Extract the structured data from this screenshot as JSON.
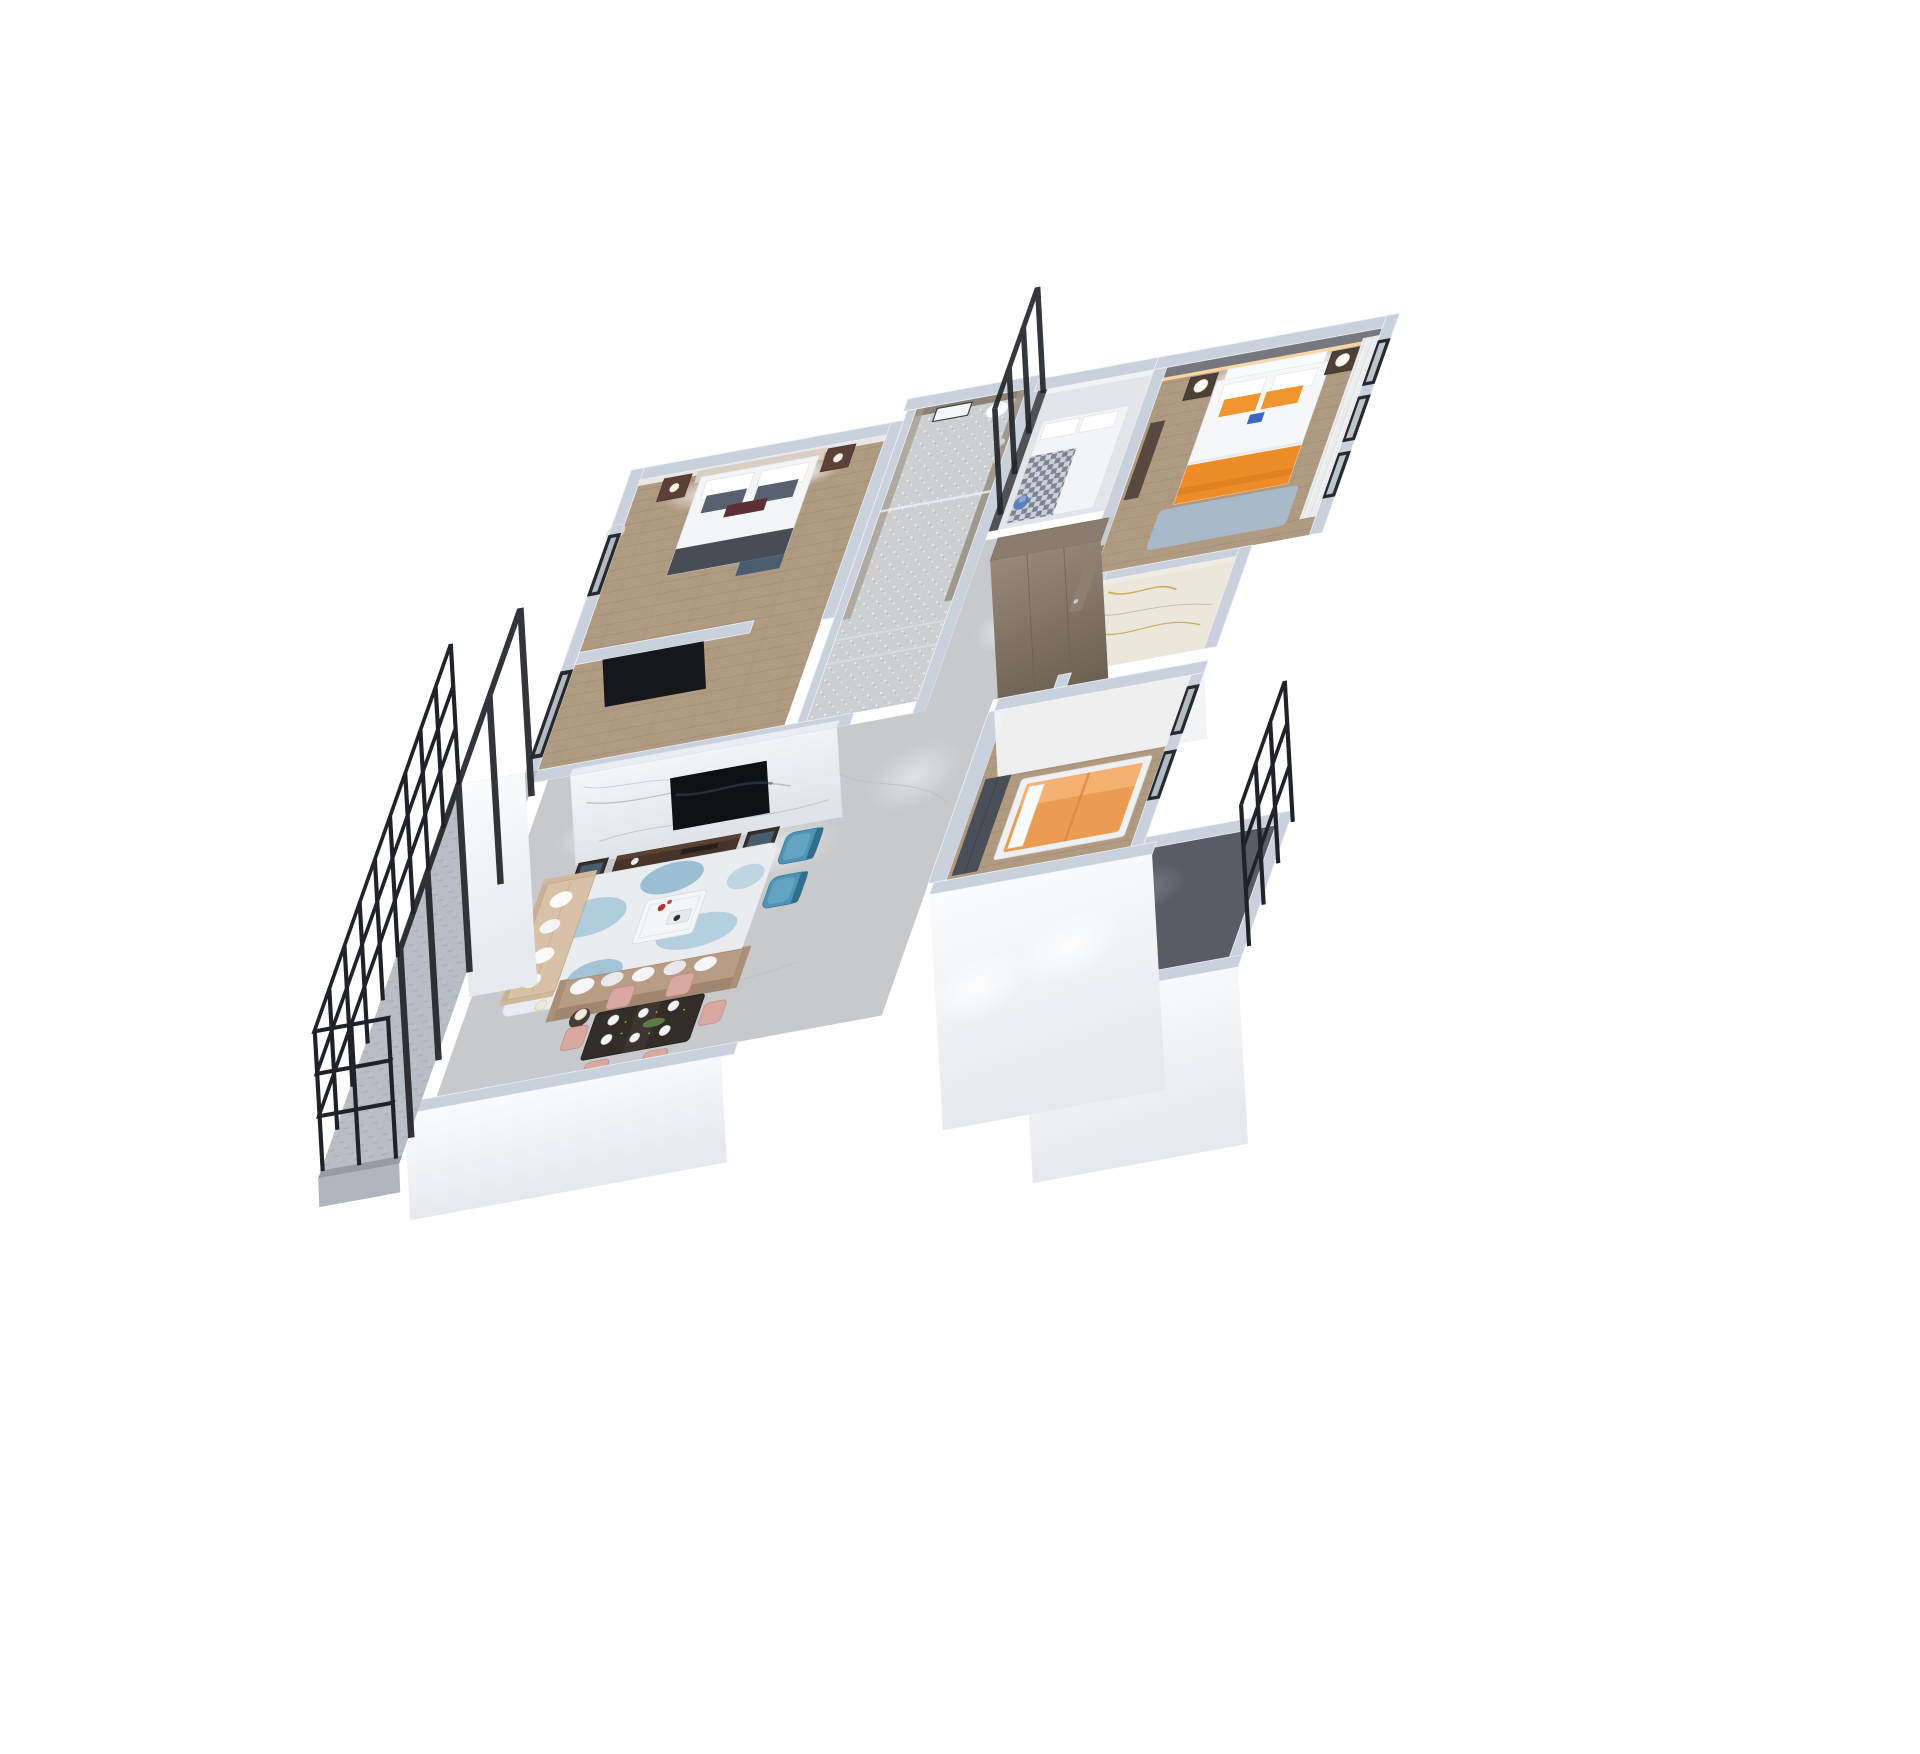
{
  "scene": {
    "title": "3D apartment floor plan render",
    "description": "Isometric cutaway (dollhouse) rendering of a three-bedroom apartment viewed from above on a plain white background, with living-dining room, two bathrooms, entry foyer and two balconies",
    "style": "photorealistic architectural visualization, oblique top-down view",
    "background": "#ffffff"
  },
  "palette": {
    "wall_top": "#c9d1dd",
    "wall_face": "#f5f7fa",
    "wood_floor": "#b09a82",
    "marble_floor": "#c7c9cc",
    "sparkle_floor": "#cdd0d2",
    "light_tile": "#e2e5e9",
    "carpet_floor": "#b7bec6",
    "dark_balcony_floor": "#575d66",
    "gold_marble": "#ece7db",
    "tv_wall_marble": "#eef0f3",
    "sofa_beige": "#d8c1a6",
    "sofa_taupe": "#b89d85",
    "accent_teal": "#4f93b5",
    "accent_orange": "#f0952f",
    "orange_throw": "#ee8d28",
    "bed3_orange": "#ec9c52",
    "dining_chair_pink": "#d9a9a1",
    "dining_table": "#332d28",
    "dark_wood": "#46332a",
    "railing_black": "#1f2329",
    "frame_black": "#23272c",
    "bathroom_taupe": "#8c8173",
    "wardrobe_taupe": "#8a7c6e",
    "cove_light": "#ffd9a2",
    "master_rug": "#a7bccf",
    "rug_base": "#e9edf0",
    "rug_blue": "#7fb2ce"
  },
  "rooms": [
    {
      "id": "bedroom-2",
      "name": "Bedroom 2",
      "floor": "wood plank",
      "furniture": [
        "double bed with dark gray and maroon pillows",
        "two dark nightstands with lamps",
        "wall-mounted TV on partition",
        "ring wall light",
        "west windows"
      ]
    },
    {
      "id": "bathroom",
      "name": "Bathroom",
      "floor": "textured stone tile",
      "furniture": [
        "toilet",
        "leaning mirror",
        "walk-in shower with glass screen",
        "chrome shower column"
      ]
    },
    {
      "id": "study-bedroom",
      "name": "Small bedroom / study",
      "floor": "light tile",
      "furniture": [
        "single bed with checkered throw",
        "blue table lamp",
        "black framed glass partition"
      ]
    },
    {
      "id": "master-bedroom",
      "name": "Master bedroom",
      "floor": "wood plank",
      "furniture": [
        "king bed with orange pillows and orange throw",
        "two nightstands with white lamps",
        "dresser",
        "blue area rug",
        "sheer curtains and east windows",
        "cove-lit headboard wall"
      ]
    },
    {
      "id": "master-bathroom",
      "name": "Master bathroom",
      "floor": "white and gold veined marble",
      "furniture": []
    },
    {
      "id": "foyer",
      "name": "Entry foyer and hallway",
      "floor": "gray marble",
      "furniture": [
        "full-height taupe wardrobe",
        "entry door with chrome handle"
      ]
    },
    {
      "id": "living-dining",
      "name": "Living and dining room",
      "floor": "gray marble",
      "furniture": [
        "white marble TV feature wall",
        "walnut TV console",
        "two dark display cabinets",
        "beige chaise sofa",
        "taupe three-seat sofa",
        "white coffee table with red flowers",
        "two teal wingback armchairs",
        "blue and white abstract rug",
        "side table with lamp",
        "dark dining table with place settings",
        "six blush dining chairs"
      ]
    },
    {
      "id": "bedroom-3",
      "name": "Bedroom 3",
      "floor": "wood plank",
      "furniture": [
        "upholstered bed with orange cover",
        "dark wardrobe",
        "east windows",
        "spot-lit south wall"
      ]
    },
    {
      "id": "balcony-west",
      "name": "West balcony",
      "floor": "gray carpet tile",
      "furniture": [
        "black metal railing",
        "black framed sliding glass doors"
      ]
    },
    {
      "id": "balcony-southeast",
      "name": "Southeast balcony",
      "floor": "dark tile",
      "furniture": [
        "black metal railing",
        "white parapet wall"
      ]
    }
  ]
}
